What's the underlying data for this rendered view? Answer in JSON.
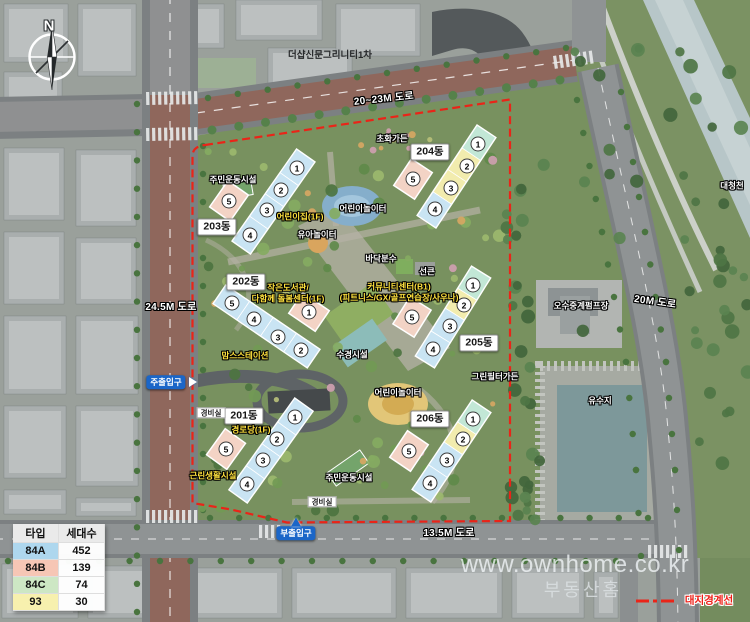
{
  "compass": {
    "north_label": "N"
  },
  "map": {
    "labels": [
      {
        "id": "neighbor-complex",
        "text": "더샵신문그리니티1차",
        "x": 330,
        "y": 56,
        "style": "dark"
      },
      {
        "id": "road-20-23m",
        "text": "20~23M 도로",
        "x": 384,
        "y": 100,
        "style": "road",
        "rot": -6
      },
      {
        "id": "flower-garden",
        "text": "초화가든",
        "x": 392,
        "y": 139,
        "style": "white"
      },
      {
        "id": "sports-facility-north",
        "text": "주민운동시설",
        "x": 233,
        "y": 180,
        "style": "white"
      },
      {
        "id": "kids-playground-north",
        "text": "어린이놀이터",
        "x": 363,
        "y": 209,
        "style": "white"
      },
      {
        "id": "daycare",
        "text": "어린이집(1F)",
        "x": 300,
        "y": 217,
        "style": "yellow"
      },
      {
        "id": "toddler-playground",
        "text": "유아놀이터",
        "x": 317,
        "y": 235,
        "style": "white"
      },
      {
        "id": "floor-fountain",
        "text": "바닥분수",
        "x": 381,
        "y": 259,
        "style": "white"
      },
      {
        "id": "sunken",
        "text": "선큰",
        "x": 427,
        "y": 272,
        "style": "white"
      },
      {
        "id": "small-library",
        "lines": [
          "작은도서관/",
          "다함께 돌봄센터(1F)"
        ],
        "x": 288,
        "y": 293,
        "style": "yellow"
      },
      {
        "id": "community-center",
        "lines": [
          "커뮤니티센터(B1)",
          "(피트니스/GX/골프연습장/사우나)"
        ],
        "x": 399,
        "y": 292,
        "style": "yellow"
      },
      {
        "id": "moms-station",
        "text": "맘스스테이션",
        "x": 245,
        "y": 356,
        "style": "yellow"
      },
      {
        "id": "water-feature",
        "text": "수경시설",
        "x": 352,
        "y": 355,
        "style": "white"
      },
      {
        "id": "green-filter-garden",
        "text": "그린필터가든",
        "x": 495,
        "y": 377,
        "style": "white"
      },
      {
        "id": "kids-playground-south",
        "text": "어린이놀이터",
        "x": 398,
        "y": 393,
        "style": "white"
      },
      {
        "id": "senior-center",
        "text": "경로당(1F)",
        "x": 251,
        "y": 430,
        "style": "yellow"
      },
      {
        "id": "neighborhood-facility",
        "text": "근린생활시설",
        "x": 213,
        "y": 476,
        "style": "yellow"
      },
      {
        "id": "sports-facility-south",
        "text": "주민운동시설",
        "x": 349,
        "y": 478,
        "style": "white"
      },
      {
        "id": "sewage-pump-station",
        "text": "오수중계펌프장",
        "x": 581,
        "y": 306,
        "style": "white"
      },
      {
        "id": "detention-pond",
        "text": "유수지",
        "x": 600,
        "y": 401,
        "style": "white"
      },
      {
        "id": "daecheong-stream",
        "text": "대청천",
        "x": 732,
        "y": 186,
        "style": "white"
      },
      {
        "id": "road-24-5m",
        "text": "24.5M 도로",
        "x": 171,
        "y": 308,
        "style": "road"
      },
      {
        "id": "road-20m",
        "text": "20M 도로",
        "x": 655,
        "y": 303,
        "style": "road",
        "rot": 8
      },
      {
        "id": "road-13-5m",
        "text": "13.5M 도로",
        "x": 449,
        "y": 534,
        "style": "road"
      },
      {
        "id": "site-boundary",
        "text": "대지경계선",
        "x": 709,
        "y": 601,
        "style": "red"
      },
      {
        "id": "guard-post-west",
        "text": "경비실",
        "x": 211,
        "y": 413,
        "style": "guard"
      },
      {
        "id": "guard-post-south",
        "text": "경비실",
        "x": 322,
        "y": 502,
        "style": "guard"
      },
      {
        "id": "main-entrance",
        "text": "주출입구",
        "x": 166,
        "y": 382,
        "style": "entrance",
        "arrow": "right"
      },
      {
        "id": "sub-entrance",
        "text": "부출입구",
        "x": 296,
        "y": 533,
        "style": "entrance",
        "arrow": "up"
      }
    ],
    "buildings": [
      {
        "id": "bldg-203",
        "name": "203동",
        "label_x": 217,
        "label_y": 227,
        "units": [
          {
            "n": "1",
            "x": 297,
            "y": 168,
            "color": "#c9e4f3"
          },
          {
            "n": "2",
            "x": 281,
            "y": 190,
            "color": "#c9e4f3"
          },
          {
            "n": "3",
            "x": 267,
            "y": 210,
            "color": "#c9e4f3"
          },
          {
            "n": "4",
            "x": 250,
            "y": 235,
            "color": "#c9e4f3"
          },
          {
            "n": "5",
            "x": 229,
            "y": 201,
            "color": "#f3d3c5",
            "pink": true
          }
        ]
      },
      {
        "id": "bldg-202",
        "name": "202동",
        "label_x": 246,
        "label_y": 282,
        "units": [
          {
            "n": "5",
            "x": 232,
            "y": 303,
            "color": "#c9e4f3"
          },
          {
            "n": "4",
            "x": 254,
            "y": 319,
            "color": "#c9e4f3"
          },
          {
            "n": "3",
            "x": 278,
            "y": 337,
            "color": "#c9e4f3"
          },
          {
            "n": "2",
            "x": 301,
            "y": 350,
            "color": "#c9e4f3"
          },
          {
            "n": "1",
            "x": 309,
            "y": 312,
            "color": "#f3d3c5",
            "pink": true
          }
        ]
      },
      {
        "id": "bldg-201",
        "name": "201동",
        "label_x": 244,
        "label_y": 416,
        "units": [
          {
            "n": "1",
            "x": 295,
            "y": 417,
            "color": "#c9e4f3"
          },
          {
            "n": "2",
            "x": 277,
            "y": 439,
            "color": "#c9e4f3"
          },
          {
            "n": "3",
            "x": 263,
            "y": 460,
            "color": "#c9e4f3"
          },
          {
            "n": "4",
            "x": 247,
            "y": 484,
            "color": "#c9e4f3"
          },
          {
            "n": "5",
            "x": 226,
            "y": 449,
            "color": "#f3d3c5",
            "pink": true
          }
        ]
      },
      {
        "id": "bldg-204",
        "name": "204동",
        "label_x": 430,
        "label_y": 152,
        "units": [
          {
            "n": "1",
            "x": 478,
            "y": 144,
            "color": "#c2e7d6"
          },
          {
            "n": "2",
            "x": 467,
            "y": 166,
            "color": "#f2ecae"
          },
          {
            "n": "3",
            "x": 451,
            "y": 188,
            "color": "#f2ecae"
          },
          {
            "n": "4",
            "x": 435,
            "y": 209,
            "color": "#c9e4f3"
          },
          {
            "n": "5",
            "x": 413,
            "y": 179,
            "color": "#f3d3c5",
            "pink": true
          }
        ]
      },
      {
        "id": "bldg-205",
        "name": "205동",
        "label_x": 479,
        "label_y": 343,
        "units": [
          {
            "n": "1",
            "x": 473,
            "y": 285,
            "color": "#c2e7d6"
          },
          {
            "n": "2",
            "x": 464,
            "y": 305,
            "color": "#f2ecae"
          },
          {
            "n": "3",
            "x": 450,
            "y": 326,
            "color": "#c9e4f3"
          },
          {
            "n": "4",
            "x": 433,
            "y": 349,
            "color": "#c9e4f3"
          },
          {
            "n": "5",
            "x": 412,
            "y": 317,
            "color": "#f3d3c5",
            "pink": true
          }
        ]
      },
      {
        "id": "bldg-206",
        "name": "206동",
        "label_x": 430,
        "label_y": 419,
        "units": [
          {
            "n": "1",
            "x": 473,
            "y": 419,
            "color": "#c2e7d6"
          },
          {
            "n": "2",
            "x": 463,
            "y": 439,
            "color": "#f2ecae"
          },
          {
            "n": "3",
            "x": 447,
            "y": 460,
            "color": "#c9e4f3"
          },
          {
            "n": "4",
            "x": 430,
            "y": 483,
            "color": "#c9e4f3"
          },
          {
            "n": "5",
            "x": 409,
            "y": 451,
            "color": "#f3d3c5",
            "pink": true
          }
        ]
      }
    ]
  },
  "legend_table": {
    "headers": [
      "타입",
      "세대수"
    ],
    "rows": [
      {
        "type": "84A",
        "households": "452",
        "color": "#aed7ee"
      },
      {
        "type": "84B",
        "households": "139",
        "color": "#f6c6b5"
      },
      {
        "type": "84C",
        "households": "74",
        "color": "#cde7c4"
      },
      {
        "type": "93",
        "households": "30",
        "color": "#f7f0ae"
      }
    ]
  },
  "watermark": {
    "line1": "www.ownhome.co.kr",
    "line2": "부동산홈"
  },
  "colors": {
    "boundary": "#ea2418",
    "entrance_blue": "#1b66c8",
    "building_84a": "#c9e4f3",
    "building_84b": "#f3d3c5",
    "building_84c": "#c2e7d6",
    "building_93": "#f2ecae"
  }
}
